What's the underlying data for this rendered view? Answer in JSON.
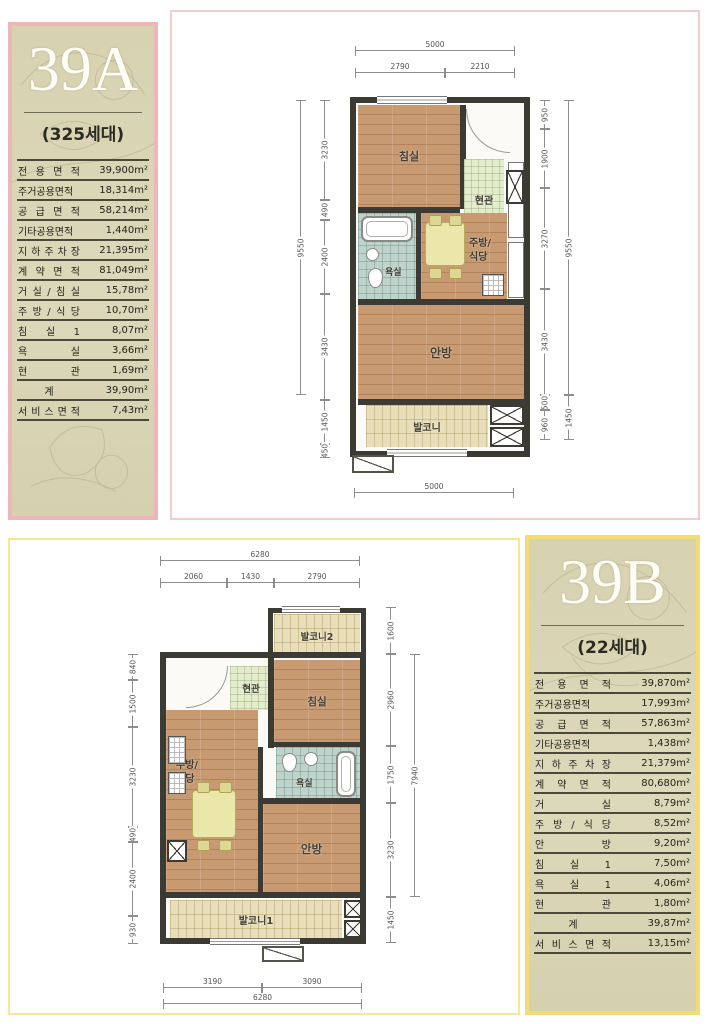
{
  "unit_a": {
    "code": "39A",
    "households": "(325세대)",
    "table": [
      {
        "label": "전 용 면 적",
        "value": "39,900m²"
      },
      {
        "label": "주거공용면적",
        "value": "18,314m²"
      },
      {
        "label": "공 급 면 적",
        "value": "58,214m²"
      },
      {
        "label": "기타공용면적",
        "value": "1,440m²"
      },
      {
        "label": "지 하 주 차 장",
        "value": "21,395m²"
      },
      {
        "label": "계 약 면 적",
        "value": "81,049m²"
      },
      {
        "label": "거 실 / 침 실",
        "value": "15,78m²"
      },
      {
        "label": "주 방 / 식 당",
        "value": "10,70m²"
      },
      {
        "label": "침 실 1",
        "value": "8,07m²"
      },
      {
        "label": "욕 실",
        "value": "3,66m²"
      },
      {
        "label": "현 관",
        "value": "1,69m²"
      },
      {
        "label": "계",
        "value": "39,90m²"
      },
      {
        "label": "서 비 스 면 적",
        "value": "7,43m²"
      }
    ],
    "plan": {
      "rooms": {
        "bedroom": "침실",
        "entry": "현관",
        "kitchen_line1": "주방/",
        "kitchen_line2": "식당",
        "bath": "욕실",
        "master": "안방",
        "balcony": "발코니"
      },
      "dims": {
        "top_total": "5000",
        "top_left": "2790",
        "top_right": "2210",
        "bottom_total": "5000",
        "left": [
          "3230",
          "490",
          "2400",
          "3430",
          "1450",
          "450"
        ],
        "left_total": "9550",
        "right": [
          "950",
          "1900",
          "3270",
          "3430",
          "500",
          "960"
        ],
        "right_total": "9550",
        "right_outer": "1450"
      }
    }
  },
  "unit_b": {
    "code": "39B",
    "households": "(22세대)",
    "table": [
      {
        "label": "전 용 면 적",
        "value": "39,870m²"
      },
      {
        "label": "주거공용면적",
        "value": "17,993m²"
      },
      {
        "label": "공 급 면 적",
        "value": "57,863m²"
      },
      {
        "label": "기타공용면적",
        "value": "1,438m²"
      },
      {
        "label": "지 하 주 차 장",
        "value": "21,379m²"
      },
      {
        "label": "계 약 면 적",
        "value": "80,680m²"
      },
      {
        "label": "거 실",
        "value": "8,79m²"
      },
      {
        "label": "주 방 / 식 당",
        "value": "8,52m²"
      },
      {
        "label": "안 방",
        "value": "9,20m²"
      },
      {
        "label": "침 실 1",
        "value": "7,50m²"
      },
      {
        "label": "욕 실 1",
        "value": "4,06m²"
      },
      {
        "label": "현 관",
        "value": "1,80m²"
      },
      {
        "label": "계",
        "value": "39,87m²"
      },
      {
        "label": "서 비 스 면 적",
        "value": "13,15m²"
      }
    ],
    "plan": {
      "rooms": {
        "balcony2": "발코니2",
        "entry": "현관",
        "bedroom": "침실",
        "kitchen_line1": "주방/",
        "kitchen_line2": "식당",
        "bath": "욕실",
        "master": "안방",
        "balcony1": "발코니1"
      },
      "dims": {
        "top_total": "6280",
        "top_segs": [
          "2060",
          "1430",
          "2790"
        ],
        "bottom_segs": [
          "3190",
          "3090"
        ],
        "bottom_total": "6280",
        "left": [
          "840",
          "1500",
          "3230",
          "490",
          "2400",
          "930"
        ],
        "right": [
          "1600",
          "2960",
          "1750",
          "3230",
          "1450"
        ],
        "right_total": "7940"
      }
    }
  }
}
